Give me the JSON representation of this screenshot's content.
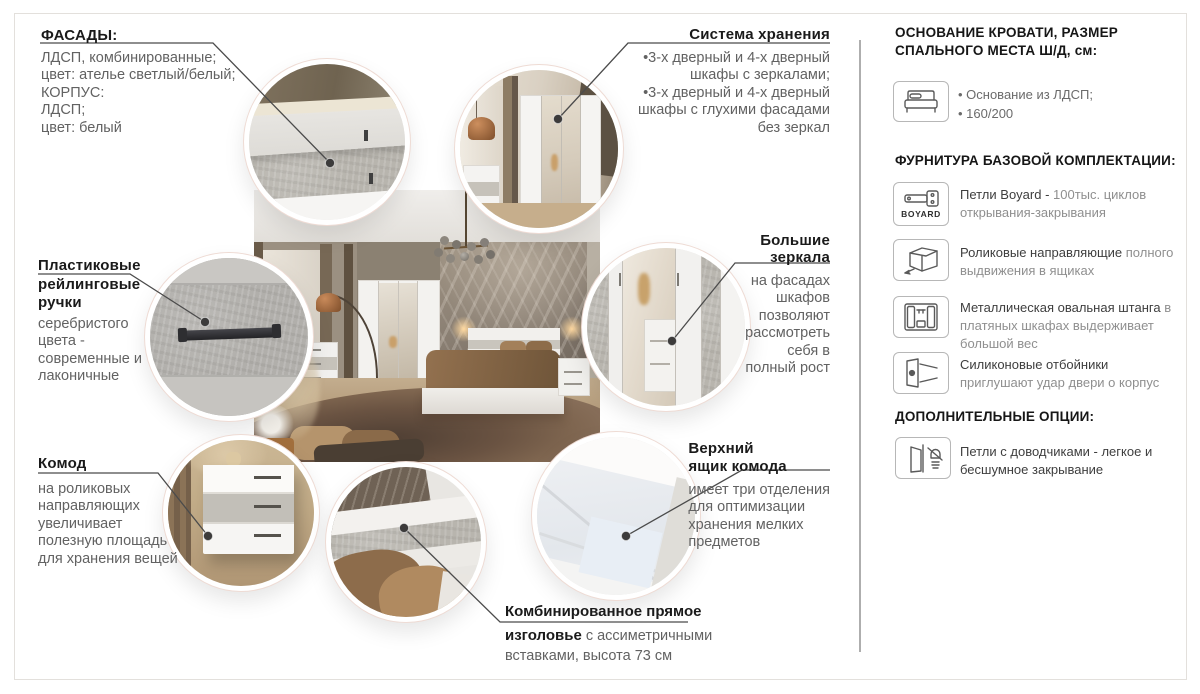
{
  "colors": {
    "heading": "#1a1a1a",
    "body_gray": "#626262",
    "leader_line": "#4a4a4a",
    "frame_border": "#e3e0dc",
    "circle_ring": "#ffffff"
  },
  "callouts": {
    "facades": {
      "title": "ФАСАДЫ:",
      "body": "ЛДСП, комбинированные;\nцвет: ателье светлый/белый;\nКОРПУС:\nЛДСП;\nцвет: белый"
    },
    "storage": {
      "title": "Система хранения",
      "body": "•3-х дверный и 4-х дверный\nшкафы с зеркалами;\n•3-х дверный и 4-х дверный\nшкафы с глухими фасадами\nбез зеркал"
    },
    "handles": {
      "title": "Пластиковые\nрейлинговые\nручки",
      "body": "серебристого\nцвета -\nсовременные и\nлаконичные"
    },
    "mirrors": {
      "title": "Большие\nзеркала",
      "body": "на фасадах\nшкафов\nпозволяют\nрассмотреть\nсебя в\nполный рост"
    },
    "dresser": {
      "title": "Комод",
      "body": "на роликовых\nнаправляющих\nувеличивает\nполезную площадь\nдля хранения вещей"
    },
    "top_drawer": {
      "title": "Верхний\nящик комода",
      "body": "имеет три отделения\nдля оптимизации\nхранения мелких\nпредметов"
    },
    "headboard": {
      "title_line1": "Комбинированное прямое",
      "title_line2": "изголовье",
      "body_inline": " с ассиметричными",
      "body_line2": "вставками, высота 73 см"
    }
  },
  "sidebar": {
    "base_heading": "ОСНОВАНИЕ КРОВАТИ, РАЗМЕР\nСПАЛЬНОГО МЕСТА Ш/Д, см:",
    "base_bullets": "• Основание из ЛДСП;\n• 160/200",
    "hardware_heading": "ФУРНИТУРА БАЗОВОЙ КОМПЛЕКТАЦИИ:",
    "items": [
      {
        "icon": "boyard-hinge-icon",
        "box_label": "BOYARD",
        "strong": "Петли Boyard - ",
        "gray": "100тыс. циклов открывания-закрывания"
      },
      {
        "icon": "drawer-slide-icon",
        "strong": "Роликовые направляющие ",
        "gray": "полного выдвижения в ящиках"
      },
      {
        "icon": "wardrobe-rail-icon",
        "strong": "Металлическая овальная штанга",
        "gray": " в платяных шкафах выдерживает большой вес"
      },
      {
        "icon": "door-bumper-icon",
        "strong": "Силиконовые отбойники ",
        "gray": "приглушают удар двери о корпус"
      }
    ],
    "options_heading": "ДОПОЛНИТЕЛЬНЫЕ ОПЦИИ:",
    "option": {
      "icon": "soft-close-hinge-icon",
      "text": "Петли с доводчиками - легкое и бесшумное закрывание"
    }
  }
}
